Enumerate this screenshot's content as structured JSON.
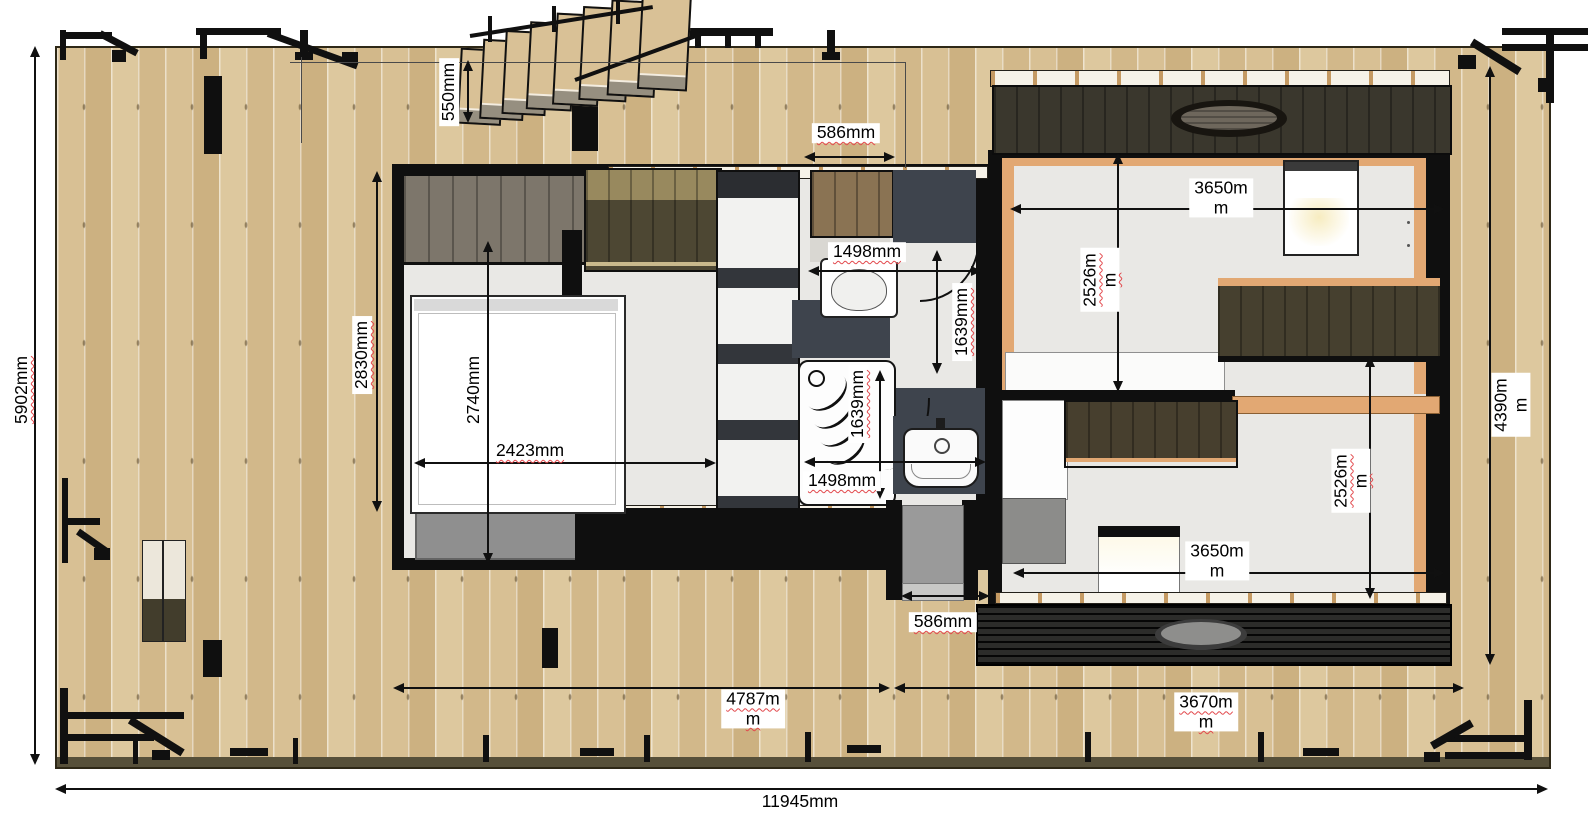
{
  "dims": {
    "deck_width": "11945mm",
    "deck_depth": "5902mm",
    "stair_offset": "550mm",
    "entry_door_width": "586mm",
    "wc_room_width": "1498mm",
    "wc_room_depth": "1639mm",
    "bathroom_depth": "1639mm",
    "bathroom_width": "1498mm",
    "rear_door_width": "586mm",
    "bedroom_depth_outer": "2830mm",
    "bedroom_depth_inner": "2740mm",
    "bedroom_width": "2423mm",
    "living_room_width": "3650m\nm",
    "living_room_depth": "2526m\nm",
    "bedroom2_depth": "2526m\nm",
    "bedroom2_width": "3650m\nm",
    "module1_length": "4787m\nm",
    "module2_length": "3670m\nm",
    "module2_depth": "4390m\nm"
  }
}
